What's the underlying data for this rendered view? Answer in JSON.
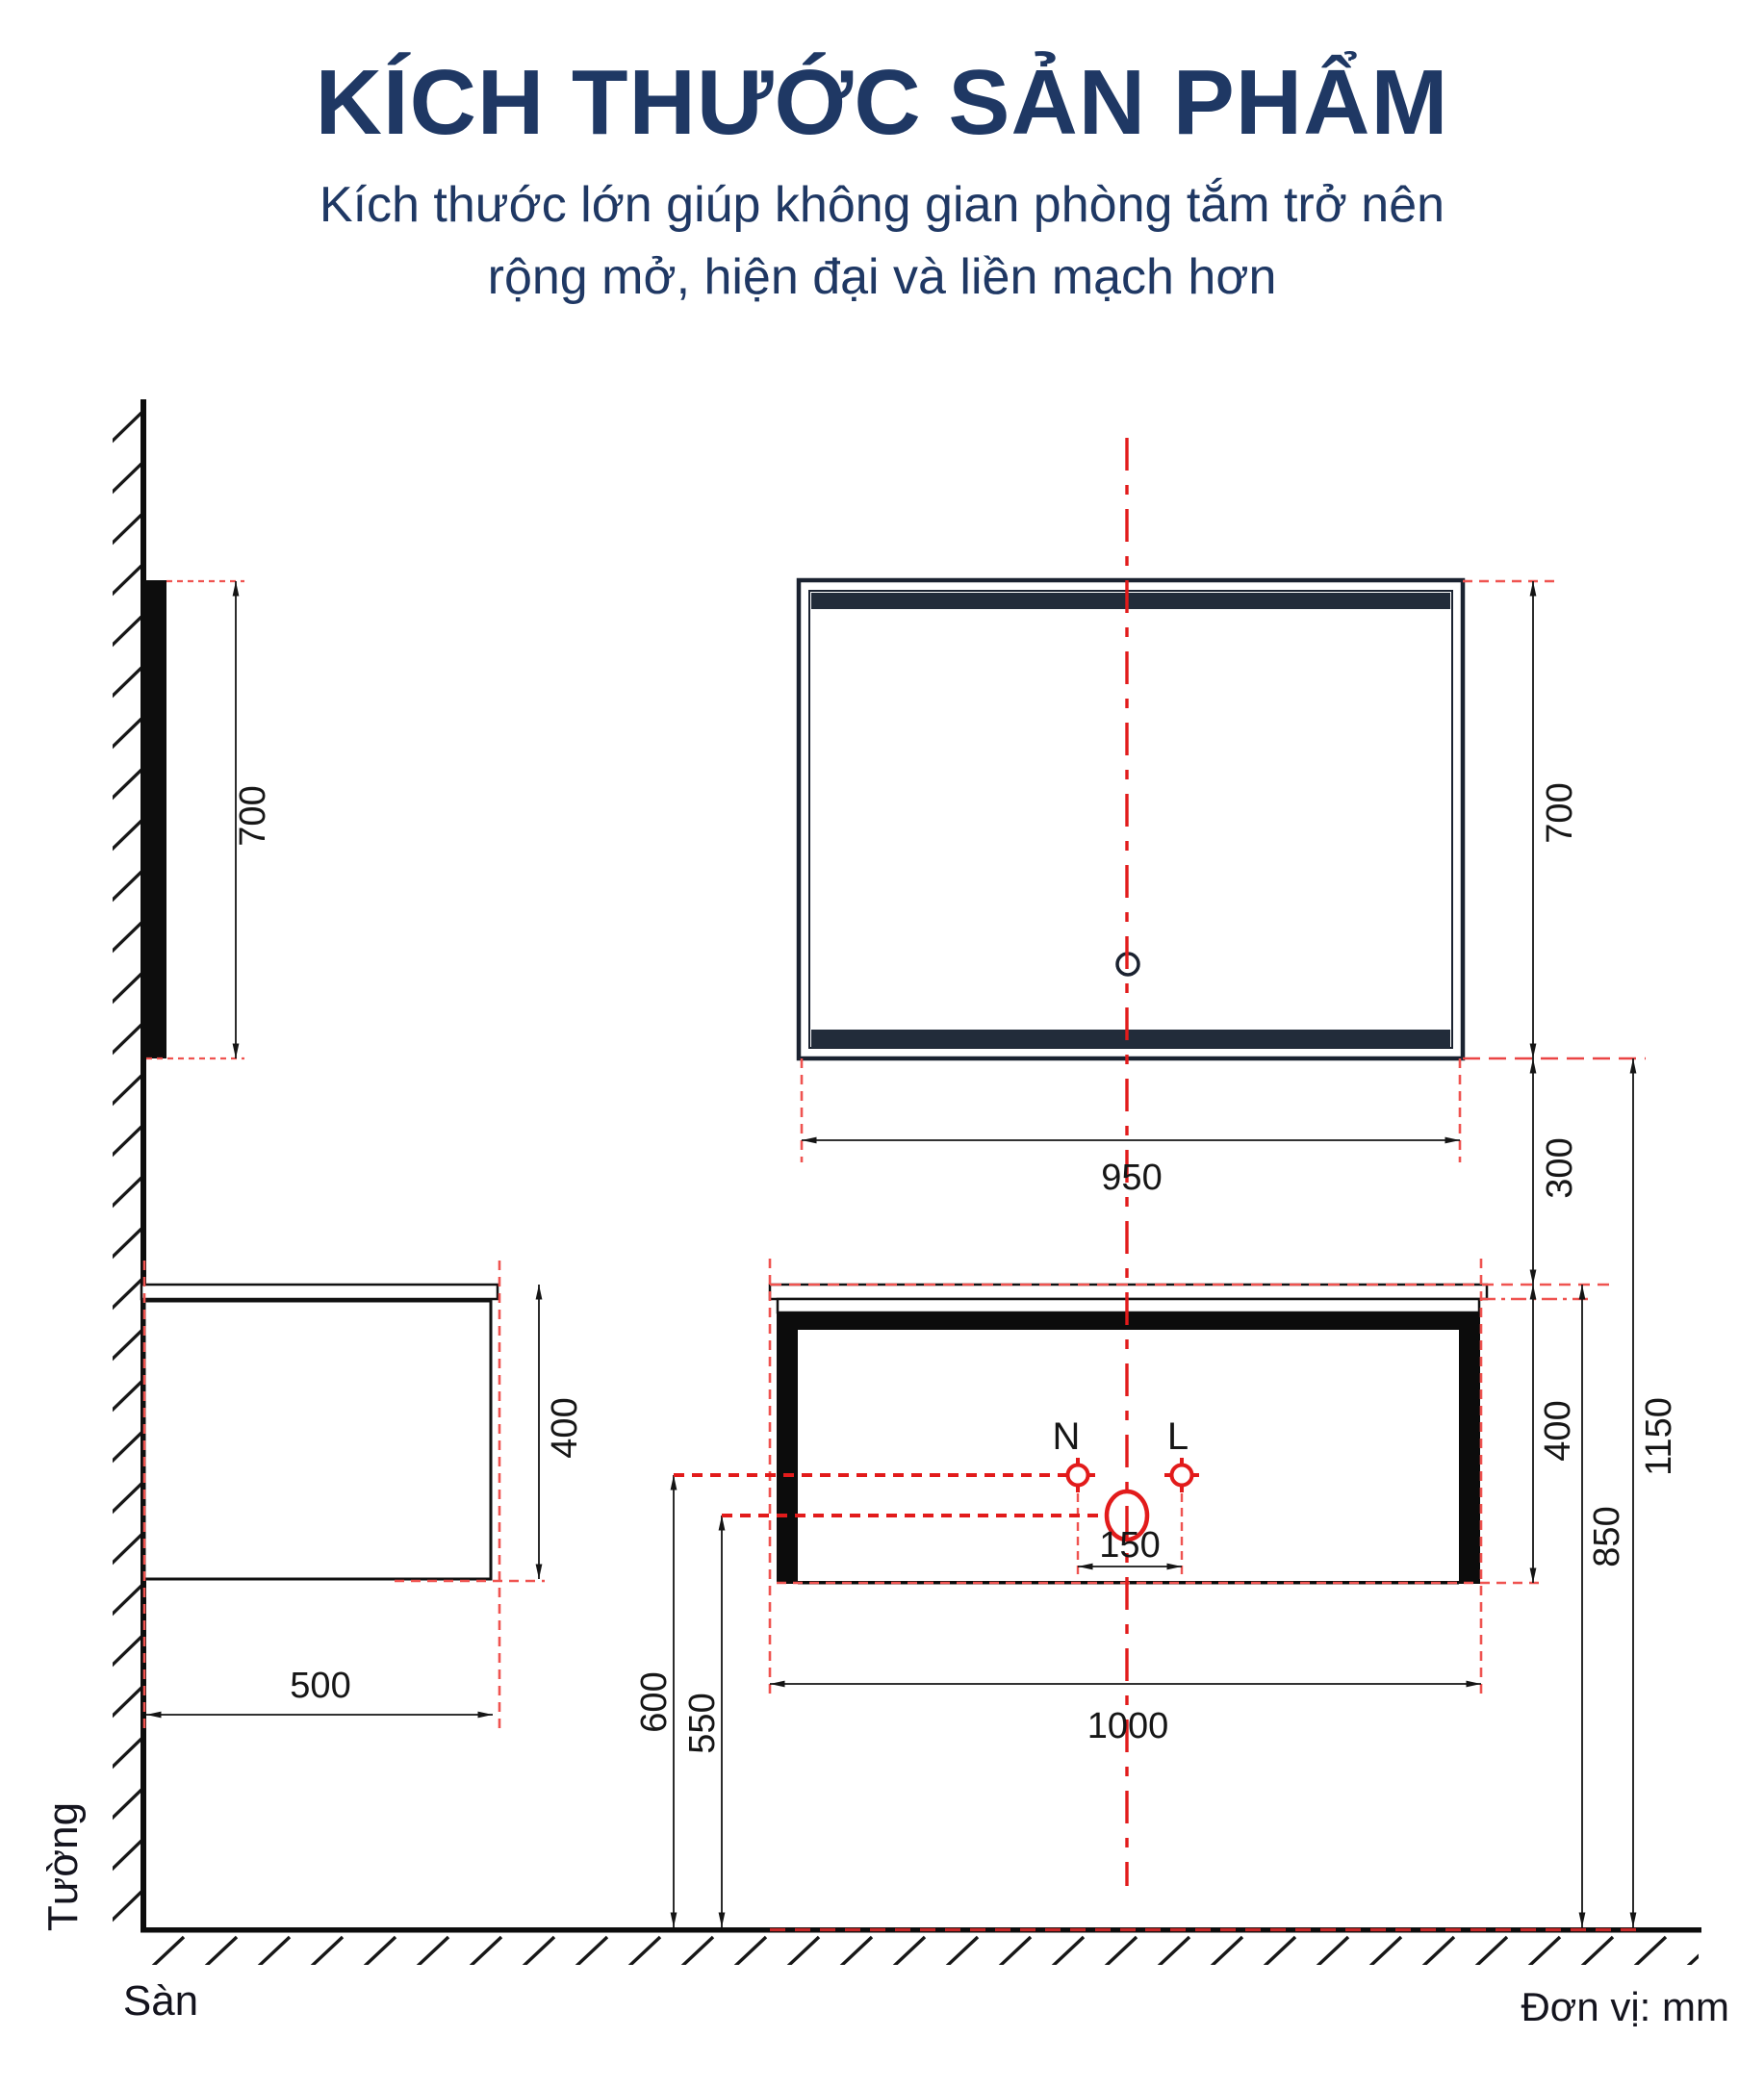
{
  "header": {
    "title": "KÍCH THƯỚC SẢN PHẨM",
    "subtitle_line1": "Kích thước lớn giúp không gian phòng tắm trở nên",
    "subtitle_line2": "rộng mở, hiện đại và liền mạch hơn"
  },
  "drawing": {
    "unit_note": "Đơn vị: mm",
    "labels": {
      "wall": "Tường",
      "floor": "Sàn",
      "neutral_terminal": "N",
      "live_terminal": "L"
    },
    "dimensions": {
      "mirror_height_side": "700",
      "mirror_height_front": "700",
      "mirror_width": "950",
      "mirror_to_cabinet_gap": "300",
      "cabinet_height_front": "400",
      "cabinet_height_side": "400",
      "cabinet_width": "1000",
      "cabinet_depth": "500",
      "faucet_hole_spacing": "150",
      "supply_height": "600",
      "drain_height": "550",
      "countertop_height": "850",
      "mirror_bottom_height": "1150"
    },
    "colors": {
      "accent_navy": "#1F3864",
      "line_black": "#151515",
      "red_strong": "#E21B1B",
      "red_light": "#EF5350",
      "frame_dark": "#1A2230"
    }
  }
}
